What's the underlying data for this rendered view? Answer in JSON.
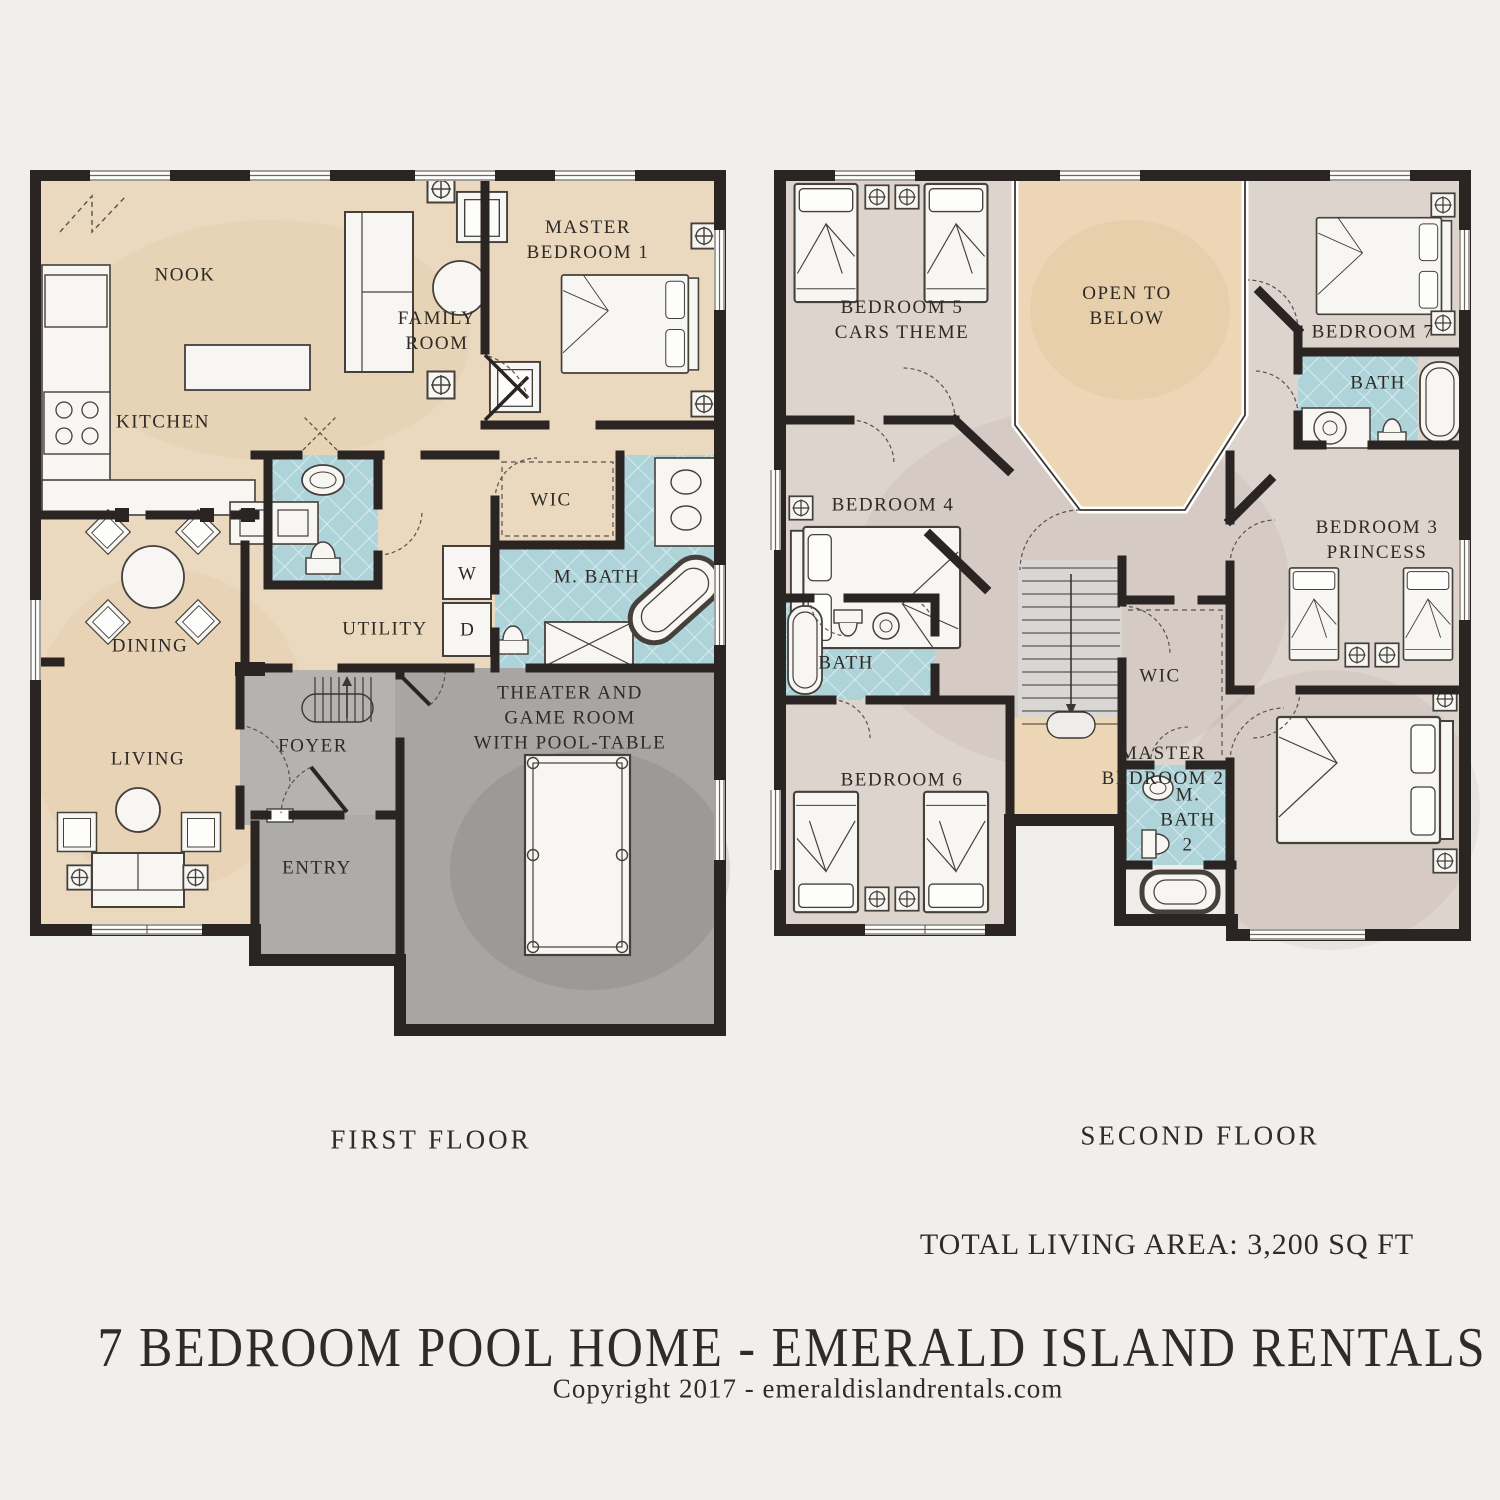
{
  "first_floor": {
    "caption": "FIRST FLOOR",
    "rooms": {
      "nook": "NOOK",
      "kitchen": "KITCHEN",
      "family_room": "FAMILY\nROOM",
      "master_bedroom_1": "MASTER\nBEDROOM 1",
      "wic": "WIC",
      "m_bath": "M. BATH",
      "dining": "DINING",
      "utility": "UTILITY",
      "washer": "W",
      "dryer": "D",
      "living": "LIVING",
      "foyer": "FOYER",
      "entry": "ENTRY",
      "theater": "THEATER AND\nGAME ROOM\nWITH POOL-TABLE"
    }
  },
  "second_floor": {
    "caption": "SECOND FLOOR",
    "rooms": {
      "bedroom_5": "BEDROOM 5\nCARS THEME",
      "open_to_below": "OPEN TO\nBELOW",
      "bedroom_7": "BEDROOM 7",
      "bath_right": "BATH",
      "bedroom_4": "BEDROOM 4",
      "bedroom_3": "BEDROOM 3\nPRINCESS",
      "bath_left": "BATH",
      "wic": "WIC",
      "bedroom_6": "BEDROOM 6",
      "m_bath_2": "M.\nBATH\n2",
      "master_bedroom_2": "MASTER\nBEDROOM 2"
    }
  },
  "summary": {
    "total_living_area": "TOTAL LIVING AREA:  3,200 SQ FT"
  },
  "footer": {
    "title": "7 BEDROOM POOL HOME - EMERALD ISLAND RENTALS",
    "copyright": "Copyright 2017 - emeraldislandrentals.com"
  },
  "colors": {
    "background": "#f1efed",
    "wall": "#2a2523",
    "floor_beige": "#ebd9bf",
    "floor_taupe": "#ddd4cd",
    "tile_blue": "#aed4da",
    "gray_foyer": "#b5b3b0",
    "gray_entry": "#aeacaa",
    "gray_theater": "#a8a6a3",
    "open_below_beige": "#ecd6b6",
    "stairs_gray": "#d8d7d4",
    "text": "#2f2b27"
  }
}
